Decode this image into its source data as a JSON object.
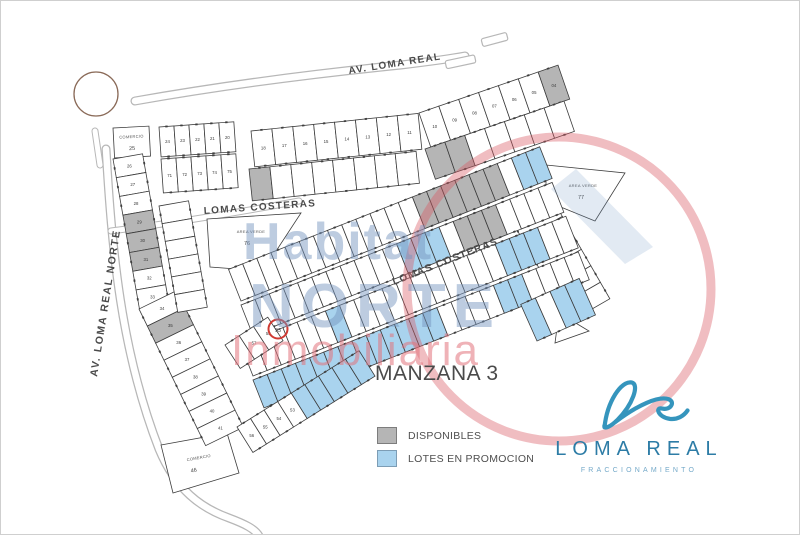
{
  "map": {
    "block_title": "MANZANA 3",
    "streets": {
      "av_loma_real": "AV. LOMA REAL",
      "av_loma_real_norte": "AV. LOMA REAL NORTE",
      "lomas_costeras_upper": "LOMAS COSTERAS",
      "lomas_costeras_diagonal": "LOMAS COSTERAS"
    },
    "areas": {
      "area_verde_left": {
        "label": "AREA VERDE",
        "number": "76"
      },
      "area_verde_right": {
        "label": "AREA VERDE",
        "number": "77"
      },
      "comercio_top": {
        "label": "COMERCIO",
        "number": "25"
      },
      "comercio_bottom": {
        "label": "COMERCIO",
        "number": "46"
      },
      "highlighted_lot": {
        "number": "93"
      }
    },
    "rows": {
      "left_a": {
        "numbers": [
          "26",
          "27",
          "28",
          "29",
          "30",
          "31",
          "32",
          "33"
        ],
        "gray": [
          3,
          4,
          5
        ]
      },
      "left_b": {
        "numbers": [
          "34",
          "35",
          "36",
          "37",
          "38",
          "39",
          "40",
          "41"
        ],
        "gray": [
          1
        ]
      },
      "midleft": {},
      "topleft_upper": {
        "numbers": [
          "24",
          "23",
          "22",
          "21",
          "20"
        ]
      },
      "topleft_lower": {
        "numbers": [
          "71",
          "72",
          "73",
          "74",
          "75"
        ]
      },
      "toparc_a_upper": {
        "numbers": [
          "18",
          "17",
          "16",
          "15",
          "14",
          "13",
          "12",
          "11"
        ]
      },
      "toparc_a_lower": {
        "gray": [
          0
        ]
      },
      "toparc_b_upper": {
        "numbers": [
          "10",
          "09",
          "08",
          "07",
          "06",
          "05",
          "04"
        ],
        "gray": [
          6
        ]
      },
      "toparc_b_lower": {
        "gray": [
          0,
          1
        ]
      },
      "right_col": {},
      "mid1_upper": {
        "gray": [
          13,
          14,
          15,
          16,
          17,
          18
        ],
        "blue": [
          20,
          21
        ]
      },
      "mid1_lower": {
        "gray": [
          15,
          16,
          17
        ],
        "blue": [
          11,
          12,
          13
        ]
      },
      "mid2_upper": {
        "blue": [
          6,
          18,
          19,
          20
        ]
      },
      "mid2_lower": {
        "blue": [
          0,
          1,
          2,
          3,
          4,
          5,
          6,
          7,
          8,
          9,
          10,
          11,
          12,
          17,
          18
        ]
      },
      "bottom_a": {
        "numbers": [
          "56",
          "55",
          "54",
          "53",
          "",
          "",
          "",
          "",
          ""
        ],
        "blue": [
          4,
          5,
          6,
          7,
          8
        ]
      },
      "right_block": {
        "blue": [
          0,
          2,
          3
        ]
      },
      "bl_grid": {
        "numbers": [
          "",
          "57",
          "58"
        ]
      }
    }
  },
  "legend": {
    "items": [
      {
        "key": "available",
        "label": "DISPONIBLES",
        "color": "#b5b5b5"
      },
      {
        "key": "promo",
        "label": "LOTES EN PROMOCION",
        "color": "#a9d3ee"
      }
    ]
  },
  "logo": {
    "name": "LOMA REAL",
    "subtitle": "FRACCIONAMIENTO"
  },
  "watermark": {
    "word1": "Habitat",
    "word2": "NORTE",
    "word3": "Inmobiliaria"
  },
  "colors": {
    "lot_fill": "#ffffff",
    "lot_available": "#b5b5b5",
    "lot_promo": "#a9d3ee",
    "lot_stroke": "#3c3c3c",
    "road": "#b7b7b7",
    "label": "#4a4a4a",
    "logo_blue": "#2d7ca6",
    "watermark_blue": "#7694be",
    "watermark_red": "#e2737b",
    "highlight_red": "#cf3a32"
  }
}
